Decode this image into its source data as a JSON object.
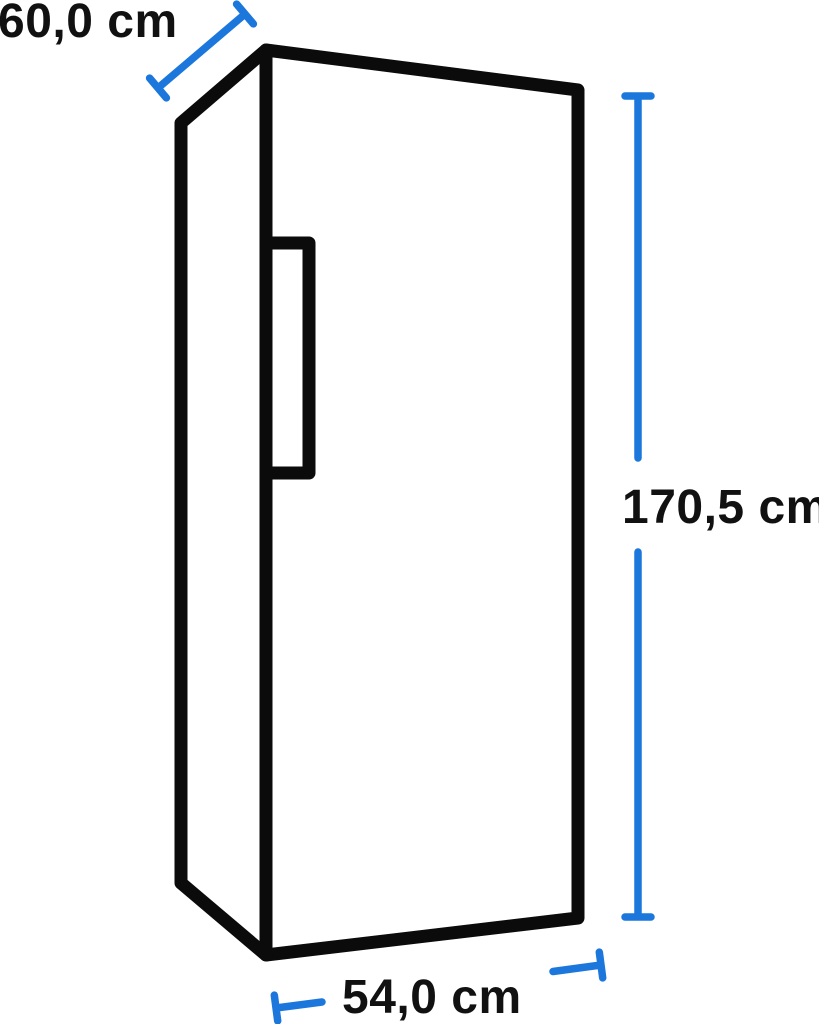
{
  "diagram": {
    "type": "product-dimension-diagram",
    "subject": "refrigerator-outline",
    "dimensions": {
      "depth": {
        "label": "60,0 cm",
        "value": 60.0,
        "unit": "cm",
        "position": "top-left-diagonal"
      },
      "height": {
        "label": "170,5 cm",
        "value": 170.5,
        "unit": "cm",
        "position": "right-vertical"
      },
      "width": {
        "label": "54,0 cm",
        "value": 54.0,
        "unit": "cm",
        "position": "bottom-horizontal"
      }
    },
    "colors": {
      "outline": "#0b0b0b",
      "dimension_line": "#1b77dc",
      "label_text": "#111111",
      "background": "#ffffff"
    }
  }
}
